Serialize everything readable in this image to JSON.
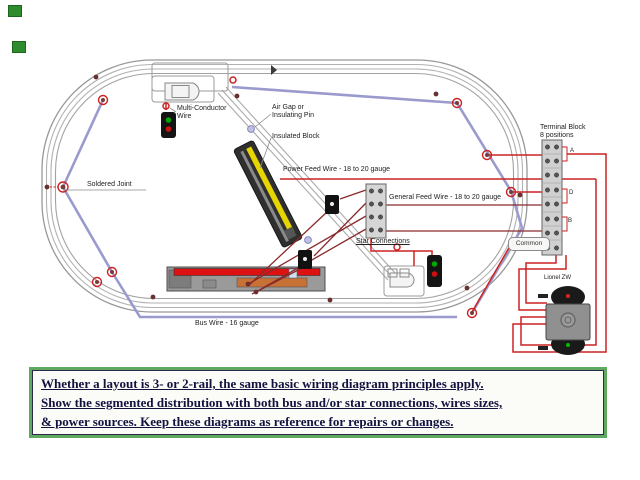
{
  "diagram": {
    "labels": {
      "multi_conductor_line1": "Multi-Conductor",
      "multi_conductor_line2": "Wire",
      "air_gap_line1": "Air Gap or",
      "air_gap_line2": "Insulating Pin",
      "insulated_block": "Insulated Block",
      "power_feed": "Power Feed Wire - 18 to 20 gauge",
      "general_feed": "General Feed Wire - 18 to 20 gauge",
      "star_connections": "Star Connections",
      "soldered_joint": "Soldered Joint",
      "bus_wire": "Bus Wire - 16 gauge",
      "terminal_block_line1": "Terminal Block",
      "terminal_block_line2": "8 positions",
      "common": "Common",
      "transformer": "Lionel ZW",
      "block_a": "A",
      "block_d": "D",
      "block_b": "B"
    },
    "colors": {
      "rail_gray": "#a8a8a8",
      "bus_wire_lavender": "#9a9ace",
      "feed_wire_red": "#cc2222",
      "star_wire_dark_red": "#7a2222",
      "insulated_section_yellow": "#e6d500",
      "signal_green": "#00a500",
      "signal_red": "#cc1111",
      "caption_border_green": "#5fa85f",
      "caption_text_navy": "#12123f"
    }
  },
  "caption": {
    "line1": "Whether a layout is 3- or 2-rail, the same basic wiring diagram  principles apply.",
    "line2": "Show the segmented distribution with both bus and/or star connections, wires sizes,",
    "line3": "& power sources. Keep these diagrams as reference for repairs or changes."
  }
}
